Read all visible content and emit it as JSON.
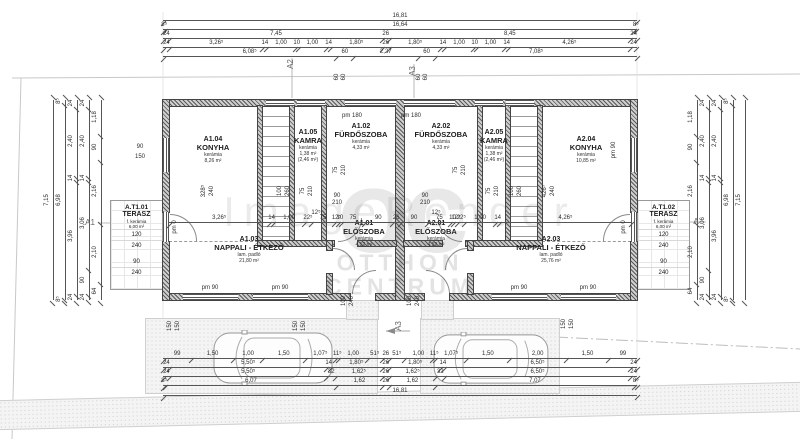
{
  "watermark": {
    "render_mark": "ImageRender",
    "brand_monogram": "oc",
    "brand_line1": "OTTHON",
    "brand_line2": "CENTRUM"
  },
  "rooms": [
    {
      "key": "a104",
      "id": "A1.04",
      "name": "KONYHA",
      "mat": "kerámia",
      "area": "8,26 m²"
    },
    {
      "key": "a105",
      "id": "A1.05",
      "name": "KAMRA",
      "mat": "kerámia",
      "area": "1,38 m²",
      "area2": "(2,46 m²)"
    },
    {
      "key": "a102",
      "id": "A1.02",
      "name": "FÜRDŐSZOBA",
      "mat": "kerámia",
      "area": "4,33 m²"
    },
    {
      "key": "a202",
      "id": "A2.02",
      "name": "FÜRDŐSZOBA",
      "mat": "kerámia",
      "area": "4,33 m²"
    },
    {
      "key": "a205",
      "id": "A2.05",
      "name": "KAMRA",
      "mat": "kerámia",
      "area": "1,38 m²",
      "area2": "(2,46 m²)"
    },
    {
      "key": "a204",
      "id": "A2.04",
      "name": "KONYHA",
      "mat": "kerámia",
      "area": "10,85 m²"
    },
    {
      "key": "a103",
      "id": "A1.03",
      "name": "NAPPALI - ÉTKEZŐ",
      "mat": "lam. padló",
      "area": "21,80 m²"
    },
    {
      "key": "a101",
      "id": "A1.01",
      "name": "ELŐSZOBA",
      "mat": "kerámia",
      "area": "4,52 m²"
    },
    {
      "key": "a201",
      "id": "A2.01",
      "name": "ELŐSZOBA",
      "mat": "kerámia",
      "area": "4,52 m²"
    },
    {
      "key": "a203",
      "id": "A2.03",
      "name": "NAPPALI - ÉTKEZŐ",
      "mat": "lam. padló",
      "area": "25,76 m²"
    }
  ],
  "terraces": [
    {
      "id": "A.T1.01",
      "name": "TERASZ",
      "mat": "f. kerámia",
      "area": "6,00 m²",
      "dims": [
        "120",
        "240",
        "90",
        "240"
      ]
    },
    {
      "id": "A.T1.02",
      "name": "TERASZ",
      "mat": "f. kerámia",
      "area": "6,00 m²",
      "dims": [
        "120",
        "240",
        "90",
        "240"
      ]
    }
  ],
  "dim_chains": [
    {
      "x": 163,
      "y": 13,
      "len": 474,
      "v": false,
      "segs": [
        [
          "16,81",
          1681
        ]
      ]
    },
    {
      "x": 163,
      "y": 22,
      "len": 474,
      "v": false,
      "segs": [
        [
          "8⁵",
          8.5
        ],
        [
          "16,64",
          1664
        ],
        [
          "8⁵",
          8.5
        ]
      ]
    },
    {
      "x": 163,
      "y": 31,
      "len": 474,
      "v": false,
      "segs": [
        [
          "24",
          24
        ],
        [
          "7,45",
          745
        ],
        [
          "26",
          26
        ],
        [
          "8,45",
          845
        ],
        [
          "24",
          24
        ]
      ]
    },
    {
      "x": 163,
      "y": 40,
      "len": 474,
      "v": false,
      "segs": [
        [
          "24",
          24
        ],
        [
          "3,26⁵",
          326.5
        ],
        [
          "14",
          14
        ],
        [
          "1,00",
          100
        ],
        [
          "10",
          10
        ],
        [
          "1,00",
          100
        ],
        [
          "14",
          14
        ],
        [
          "1,80⁵",
          180.5
        ],
        [
          "26",
          26
        ],
        [
          "1,80⁵",
          180.5
        ],
        [
          "14",
          14
        ],
        [
          "1,00",
          100
        ],
        [
          "10",
          10
        ],
        [
          "1,00",
          100
        ],
        [
          "14",
          14
        ],
        [
          "4,26⁵",
          426.5
        ],
        [
          "24",
          24
        ]
      ]
    },
    {
      "x": 163,
      "y": 49,
      "len": 474,
      "v": false,
      "segs": [
        [
          "6,08⁵",
          608.5
        ],
        [
          "60",
          60
        ],
        [
          "2,27",
          227
        ],
        [
          "60",
          60
        ],
        [
          "7,08⁵",
          708.5
        ]
      ]
    },
    {
      "x": 169,
      "y": 215,
      "len": 462,
      "v": false,
      "segs": [
        [
          "3,26⁵",
          326.5
        ],
        [
          "14",
          14
        ],
        [
          "1,00",
          100
        ],
        [
          "22⁵",
          22.5
        ],
        [
          "75",
          75
        ],
        [
          "12⁵",
          12.5
        ],
        [
          "10",
          10
        ],
        [
          "75",
          75
        ],
        [
          "90",
          90
        ],
        [
          "26",
          26
        ],
        [
          "90",
          90
        ],
        [
          "75",
          75
        ],
        [
          "10",
          10
        ],
        [
          "12⁵",
          12.5
        ],
        [
          "22⁵",
          22.5
        ],
        [
          "1,00",
          100
        ],
        [
          "14",
          14
        ],
        [
          "4,26⁵",
          426.5
        ]
      ]
    },
    {
      "x": 163,
      "y": 351,
      "len": 474,
      "v": false,
      "segs": [
        [
          "99",
          99
        ],
        [
          "1,50",
          150
        ],
        [
          "1,00",
          100
        ],
        [
          "1,50",
          150
        ],
        [
          "1,07⁵",
          107.5
        ],
        [
          "11⁵",
          11.5
        ],
        [
          "1,00",
          100
        ],
        [
          "51⁵",
          51.5
        ],
        [
          "26",
          26
        ],
        [
          "51⁵",
          51.5
        ],
        [
          "1,00",
          100
        ],
        [
          "11⁵",
          11.5
        ],
        [
          "1,07⁵",
          107.5
        ],
        [
          "1,50",
          150
        ],
        [
          "2,00",
          200
        ],
        [
          "1,50",
          150
        ],
        [
          "99",
          99
        ]
      ]
    },
    {
      "x": 163,
      "y": 360,
      "len": 474,
      "v": false,
      "segs": [
        [
          "24",
          24
        ],
        [
          "5,50⁵",
          550.5
        ],
        [
          "14",
          14
        ],
        [
          "1,80⁵",
          180.5
        ],
        [
          "26",
          26
        ],
        [
          "1,80⁵",
          180.5
        ],
        [
          "14",
          14
        ],
        [
          "6,50⁵",
          650.5
        ],
        [
          "24",
          24
        ]
      ]
    },
    {
      "x": 163,
      "y": 369,
      "len": 474,
      "v": false,
      "segs": [
        [
          "24",
          24
        ],
        [
          "5,50⁵",
          550.5
        ],
        [
          "32",
          32
        ],
        [
          "1,62⁵",
          162.5
        ],
        [
          "26",
          26
        ],
        [
          "1,62⁵",
          162.5
        ],
        [
          "32",
          32
        ],
        [
          "6,50⁵",
          650.5
        ],
        [
          "24",
          24
        ]
      ]
    },
    {
      "x": 163,
      "y": 378,
      "len": 474,
      "v": false,
      "segs": [
        [
          "8⁵",
          8.5
        ],
        [
          "6,07",
          607
        ],
        [
          "1,62",
          162
        ],
        [
          "26",
          26
        ],
        [
          "1,62",
          162
        ],
        [
          "7,07",
          707
        ],
        [
          "8⁵",
          8.5
        ]
      ]
    },
    {
      "x": 163,
      "y": 388,
      "len": 474,
      "v": false,
      "segs": [
        [
          "16,81",
          1681
        ]
      ]
    },
    {
      "x": 46,
      "y": 100,
      "len": 200,
      "v": true,
      "segs": [
        [
          "7,15",
          715
        ]
      ]
    },
    {
      "x": 58,
      "y": 100,
      "len": 200,
      "v": true,
      "segs": [
        [
          "8⁵",
          8.5
        ],
        [
          "6,98",
          698
        ],
        [
          "8⁵",
          8.5
        ]
      ]
    },
    {
      "x": 70,
      "y": 100,
      "len": 200,
      "v": true,
      "segs": [
        [
          "24",
          24
        ],
        [
          "2,40",
          240
        ],
        [
          "14",
          14
        ],
        [
          "3,96",
          396
        ],
        [
          "24",
          24
        ]
      ]
    },
    {
      "x": 82,
      "y": 100,
      "len": 200,
      "v": true,
      "segs": [
        [
          "24",
          24
        ],
        [
          "2,40",
          240
        ],
        [
          "14",
          14
        ],
        [
          "3,06",
          306
        ],
        [
          "90",
          90
        ],
        [
          "24",
          24
        ]
      ]
    },
    {
      "x": 94,
      "y": 100,
      "len": 200,
      "v": true,
      "segs": [
        [
          "1,18",
          118
        ],
        [
          "90",
          90
        ],
        [
          "2,16",
          216
        ],
        [
          "2,10",
          210
        ],
        [
          "64",
          64
        ]
      ]
    },
    {
      "x": 690,
      "y": 100,
      "len": 200,
      "v": true,
      "segs": [
        [
          "1,18",
          118
        ],
        [
          "90",
          90
        ],
        [
          "2,16",
          216
        ],
        [
          "2,10",
          210
        ],
        [
          "64",
          64
        ]
      ]
    },
    {
      "x": 702,
      "y": 100,
      "len": 200,
      "v": true,
      "segs": [
        [
          "24",
          24
        ],
        [
          "2,40",
          240
        ],
        [
          "14",
          14
        ],
        [
          "3,06",
          306
        ],
        [
          "90",
          90
        ],
        [
          "24",
          24
        ]
      ]
    },
    {
      "x": 714,
      "y": 100,
      "len": 200,
      "v": true,
      "segs": [
        [
          "24",
          24
        ],
        [
          "2,40",
          240
        ],
        [
          "14",
          14
        ],
        [
          "3,96",
          396
        ],
        [
          "24",
          24
        ]
      ]
    },
    {
      "x": 726,
      "y": 100,
      "len": 200,
      "v": true,
      "segs": [
        [
          "8⁵",
          8.5
        ],
        [
          "6,98",
          698
        ],
        [
          "8⁵",
          8.5
        ]
      ]
    },
    {
      "x": 738,
      "y": 100,
      "len": 200,
      "v": true,
      "segs": [
        [
          "7,15",
          715
        ]
      ]
    }
  ],
  "annotations": [
    {
      "t": "pm 180",
      "x": 352,
      "y": 116
    },
    {
      "t": "pm 180",
      "x": 411,
      "y": 116
    },
    {
      "t": "pm 90",
      "x": 210,
      "y": 288
    },
    {
      "t": "pm 90",
      "x": 280,
      "y": 288
    },
    {
      "t": "pm 90",
      "x": 519,
      "y": 288
    },
    {
      "t": "pm 90",
      "x": 588,
      "y": 288
    },
    {
      "t": "pm 0",
      "x": 175,
      "y": 227,
      "r": 1
    },
    {
      "t": "pm 0",
      "x": 624,
      "y": 227,
      "r": 1
    },
    {
      "t": "pm 90",
      "x": 614,
      "y": 150,
      "r": 1
    },
    {
      "t": "90",
      "x": 140,
      "y": 147
    },
    {
      "t": "150",
      "x": 140,
      "y": 157
    },
    {
      "t": "90",
      "x": 337,
      "y": 196
    },
    {
      "t": "210",
      "x": 337,
      "y": 203
    },
    {
      "t": "90",
      "x": 425,
      "y": 196
    },
    {
      "t": "210",
      "x": 425,
      "y": 203
    },
    {
      "t": "12⁵",
      "x": 316,
      "y": 213
    },
    {
      "t": "12⁵",
      "x": 436,
      "y": 213
    },
    {
      "t": "328⁵",
      "x": 204,
      "y": 191,
      "r": 1
    },
    {
      "t": "240",
      "x": 212,
      "y": 191,
      "r": 1
    },
    {
      "t": "100",
      "x": 280,
      "y": 191,
      "r": 1
    },
    {
      "t": "260",
      "x": 288,
      "y": 191,
      "r": 1
    },
    {
      "t": "75",
      "x": 303,
      "y": 191,
      "r": 1
    },
    {
      "t": "210",
      "x": 311,
      "y": 191,
      "r": 1
    },
    {
      "t": "75",
      "x": 336,
      "y": 170,
      "r": 1
    },
    {
      "t": "210",
      "x": 344,
      "y": 170,
      "r": 1
    },
    {
      "t": "75",
      "x": 456,
      "y": 170,
      "r": 1
    },
    {
      "t": "210",
      "x": 464,
      "y": 170,
      "r": 1
    },
    {
      "t": "75",
      "x": 489,
      "y": 191,
      "r": 1
    },
    {
      "t": "210",
      "x": 497,
      "y": 191,
      "r": 1
    },
    {
      "t": "100",
      "x": 512,
      "y": 191,
      "r": 1
    },
    {
      "t": "260",
      "x": 520,
      "y": 191,
      "r": 1
    },
    {
      "t": "426⁵",
      "x": 545,
      "y": 191,
      "r": 1
    },
    {
      "t": "240",
      "x": 553,
      "y": 191,
      "r": 1
    },
    {
      "t": "60",
      "x": 337,
      "y": 77,
      "r": 1
    },
    {
      "t": "60",
      "x": 344,
      "y": 77,
      "r": 1
    },
    {
      "t": "60",
      "x": 419,
      "y": 77,
      "r": 1
    },
    {
      "t": "60",
      "x": 426,
      "y": 77,
      "r": 1
    },
    {
      "t": "A2",
      "x": 291,
      "y": 64,
      "r": 1,
      "m": 1
    },
    {
      "t": "A3",
      "x": 413,
      "y": 71,
      "r": 1,
      "m": 1
    },
    {
      "t": "A1",
      "x": 90,
      "y": 223,
      "m": 1
    },
    {
      "t": "A",
      "x": 696,
      "y": 222,
      "m": 1
    },
    {
      "t": "A3",
      "x": 399,
      "y": 326,
      "r": 1,
      "m": 1
    },
    {
      "t": "100",
      "x": 344,
      "y": 301,
      "r": 1
    },
    {
      "t": "240",
      "x": 352,
      "y": 301,
      "r": 1
    },
    {
      "t": "100",
      "x": 410,
      "y": 301,
      "r": 1
    },
    {
      "t": "240",
      "x": 418,
      "y": 301,
      "r": 1
    },
    {
      "t": "150",
      "x": 170,
      "y": 326,
      "r": 1
    },
    {
      "t": "150",
      "x": 178,
      "y": 326,
      "r": 1
    },
    {
      "t": "150",
      "x": 296,
      "y": 326,
      "r": 1
    },
    {
      "t": "150",
      "x": 304,
      "y": 326,
      "r": 1
    },
    {
      "t": "150",
      "x": 564,
      "y": 324,
      "r": 1
    },
    {
      "t": "150",
      "x": 572,
      "y": 324,
      "r": 1
    }
  ]
}
